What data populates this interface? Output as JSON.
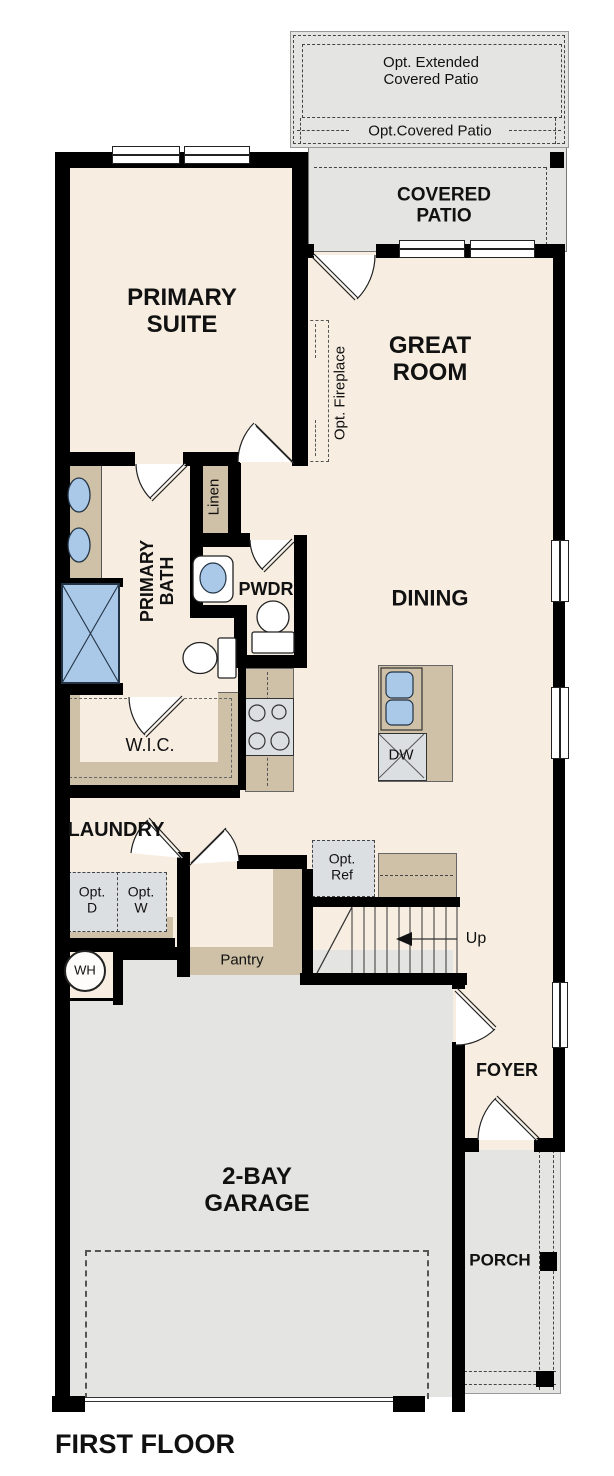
{
  "floor_plan": {
    "title": "FIRST FLOOR",
    "rooms": {
      "opt_extended_covered_patio": "Opt. Extended\nCovered Patio",
      "opt_covered_patio": "Opt.Covered Patio",
      "covered_patio": "COVERED\nPATIO",
      "primary_suite": "PRIMARY\nSUITE",
      "great_room": "GREAT\nROOM",
      "opt_fireplace": "Opt. Fireplace",
      "primary_bath": "PRIMARY\nBATH",
      "linen": "Linen",
      "powder": "PWDR",
      "dining": "DINING",
      "wic": "W.I.C.",
      "dishwasher": "DW",
      "laundry": "LAUNDRY",
      "opt_dryer": "Opt.\nD",
      "opt_washer": "Opt.\nW",
      "opt_refrigerator": "Opt.\nRef",
      "pantry": "Pantry",
      "stairs_up": "Up",
      "water_heater": "WH",
      "foyer": "FOYER",
      "garage": "2-BAY\nGARAGE",
      "porch": "PORCH"
    },
    "colors": {
      "floor": "#f7eee1",
      "outdoor": "#e4e4e2",
      "cabinetry": "#cfc1a7",
      "appliance": "#dcdfe1",
      "fixture_blue": "#aac9e9",
      "wall": "#000000"
    }
  }
}
